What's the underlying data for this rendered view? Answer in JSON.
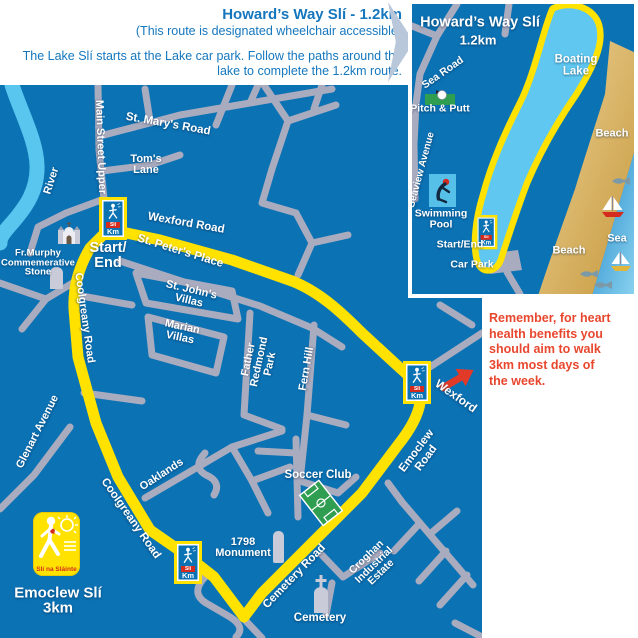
{
  "header": {
    "title": "Howard’s Way Slí - 1.2km",
    "subtitle": "(This route is designated wheelchair accessible)",
    "description": "The Lake Slí starts at the Lake car park. Follow the paths around the\nlake to complete the 1.2km route."
  },
  "note": {
    "text": "Remember, for heart\nhealth benefits you\nshould aim to walk\n3km most days of\nthe week."
  },
  "main_map": {
    "labels": {
      "river": "River",
      "main_street_upper": "Main Street Upper",
      "st_marys_road": "St. Mary's Road",
      "toms_lane": "Tom's\nLane",
      "wexford_road": "Wexford Road",
      "start_end": "Start/\nEnd",
      "st_peters_place": "St. Peter's Place",
      "fr_murphy": "Fr.Murphy\nCommemerative\nStone",
      "coolgreany_road_upper": "Coolgreany Road",
      "st_johns_villas": "St. John's\nVillas",
      "marian_villas": "Marian\nVillas",
      "glenart_avenue": "Glenart Avenue",
      "father_redmond_park": "Father\nRedmond\nPark",
      "fern_hill": "Fern Hill",
      "coolgreany_road_lower": "Coolgreany Road",
      "oaklands": "Oaklands",
      "soccer_club": "Soccer Club",
      "emoclew_road": "Emoclew Road",
      "wexford_direction": "Wexford",
      "monument_1798": "1798\nMonument",
      "cemetery_road": "Cemetery Road",
      "croghan_estate": "Croghan\nIndustrial\nEstate",
      "cemetery": "Cemetery",
      "route_title": "Emoclew Slí\n3km"
    }
  },
  "inset_map": {
    "title": "Howard’s Way Slí",
    "distance": "1.2km",
    "labels": {
      "sea_road": "Sea Road",
      "pitch_putt": "Pitch & Putt",
      "boating_lake": "Boating\nLake",
      "beach_upper": "Beach",
      "beach_lower": "Beach",
      "sea": "Sea",
      "seaview_avenue": "Seaview Avenue",
      "swimming_pool": "Swimming\nPool",
      "start_end": "Start/End",
      "car_park": "Car Park"
    }
  },
  "km_marker": {
    "chip": "Slí",
    "km": "Km"
  },
  "logo": {
    "text": "Slí na Sláinte"
  },
  "colors": {
    "map_blue": "#0B72B4",
    "route_yellow": "#FFE200",
    "road_grey": "#A9ABBE",
    "water_blue": "#5EC8F0",
    "beach_sand": "#D9AE5F",
    "heading_blue": "#1577BE",
    "note_red": "#E8472E"
  }
}
